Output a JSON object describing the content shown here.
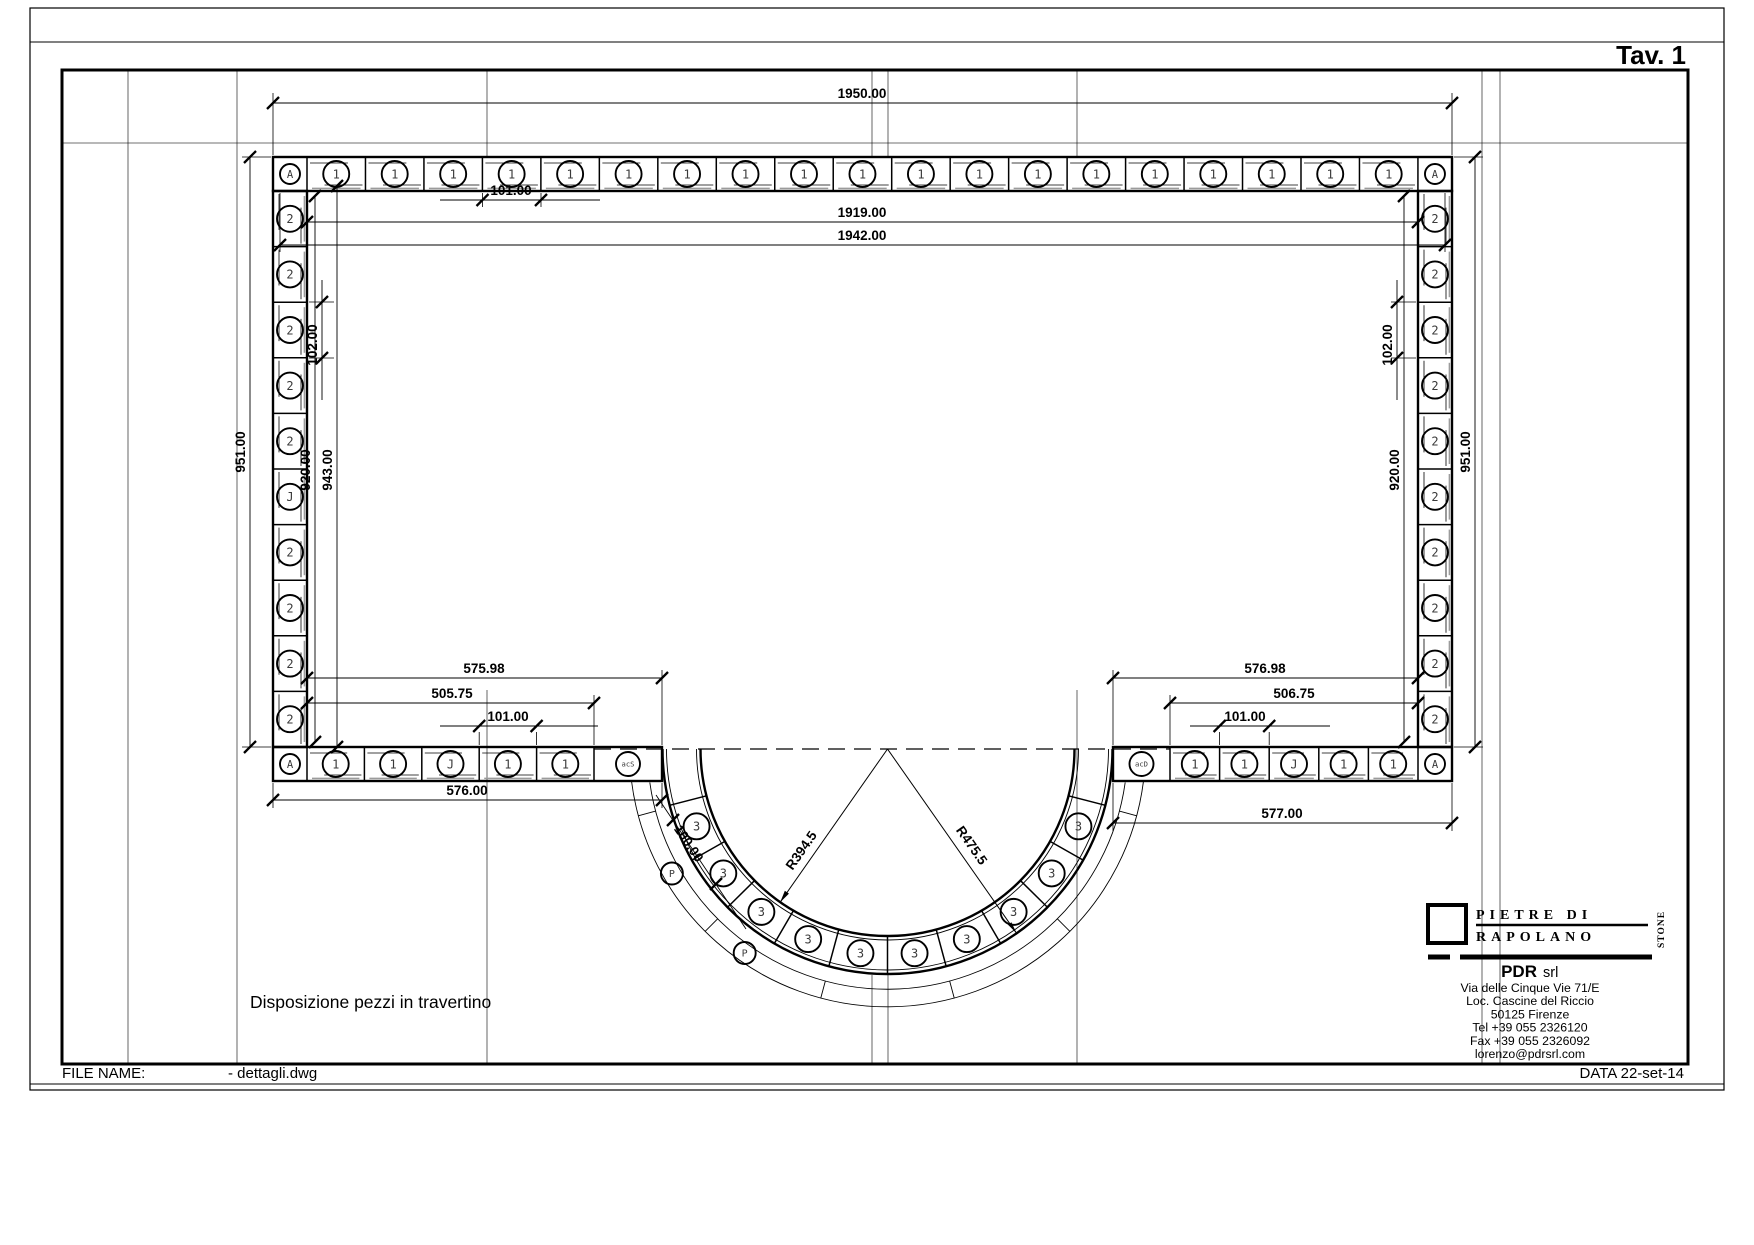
{
  "sheet": {
    "tav": "Tav. 1",
    "caption": "Disposizione pezzi in travertino",
    "file_label": "FILE NAME:",
    "file_name": "- dettagli.dwg",
    "date": "DATA 22-set-14"
  },
  "company": {
    "logo_line1": "PIETRE DI",
    "logo_line2": "RAPOLANO",
    "logo_side": "STONE",
    "name_bold": "PDR",
    "name_suffix": "srl",
    "address": [
      "Via delle Cinque Vie 71/E",
      "Loc. Cascine del Riccio",
      "50125 Firenze",
      "Tel +39  055 2326120",
      "Fax +39 055 2326092",
      "lorenzo@pdrsrl.com"
    ]
  },
  "dims": {
    "top_width": "1950.00",
    "top_piece": "101.00",
    "inner_width_1": "1919.00",
    "inner_width_2": "1942.00",
    "left_outer_h": "951.00",
    "left_piece": "102.00",
    "left_inner_h": "920.00",
    "left_inner_h2": "943.00",
    "right_outer_h": "951.00",
    "right_piece": "102.00",
    "right_inner_h": "920.00",
    "bl_a": "575.98",
    "bl_b": "505.75",
    "bl_piece": "101.00",
    "bl_width": "576.00",
    "br_a": "576.98",
    "br_b": "506.75",
    "br_piece": "101.00",
    "br_width": "577.00",
    "arc_piece": "100.00",
    "radius_inner": "R394.5",
    "radius_outer": "R475.5"
  },
  "pieces": {
    "top_row": [
      "A",
      "1",
      "1",
      "1",
      "1",
      "1",
      "1",
      "1",
      "1",
      "1",
      "1",
      "1",
      "1",
      "1",
      "1",
      "1",
      "1",
      "1",
      "1",
      "1",
      "A"
    ],
    "left_col": [
      "2",
      "2",
      "2",
      "2",
      "2",
      "J",
      "2",
      "2",
      "2",
      "2"
    ],
    "right_col": [
      "2",
      "2",
      "2",
      "2",
      "2",
      "2",
      "2",
      "2",
      "2",
      "2"
    ],
    "bottom_left": [
      "A",
      "1",
      "1",
      "J",
      "1",
      "1",
      "acS"
    ],
    "bottom_right": [
      "acD",
      "1",
      "1",
      "J",
      "1",
      "1",
      "A"
    ],
    "arc": [
      "3",
      "3",
      "3",
      "3",
      "3",
      "3",
      "3",
      "3",
      "3",
      "3"
    ],
    "ring": [
      "P",
      "P"
    ]
  }
}
